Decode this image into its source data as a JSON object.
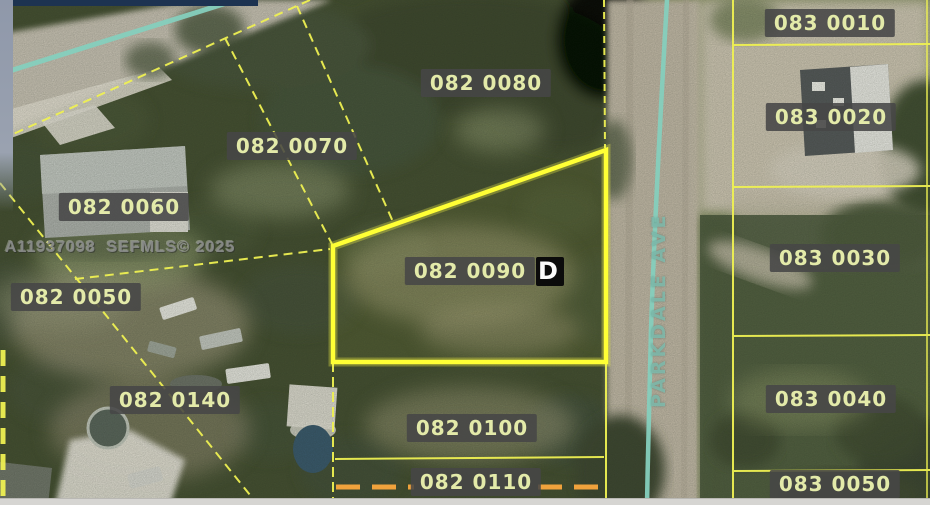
{
  "watermark": "A11937098  SEFMLS© 2025",
  "street": {
    "name": "PARKDALE AVE"
  },
  "subject_parcel_id": "082 0090",
  "subject_marker_glyph": "D",
  "parcels": [
    {
      "id": "082 0080"
    },
    {
      "id": "082 0070"
    },
    {
      "id": "082 0060"
    },
    {
      "id": "082 0050"
    },
    {
      "id": "082 0090"
    },
    {
      "id": "082 0140"
    },
    {
      "id": "082 0100"
    },
    {
      "id": "082 0110"
    },
    {
      "id": "083 0010"
    },
    {
      "id": "083 0020"
    },
    {
      "id": "083 0030"
    },
    {
      "id": "083 0040"
    },
    {
      "id": "083 0050"
    }
  ],
  "colors": {
    "parcel_line": "#eef052",
    "subject_boundary": "#ffff35",
    "highlight_orange": "#f0a23c",
    "road_centerline": "#85cfbd",
    "label_background": "#474747",
    "label_text": "#e3eaa9"
  }
}
